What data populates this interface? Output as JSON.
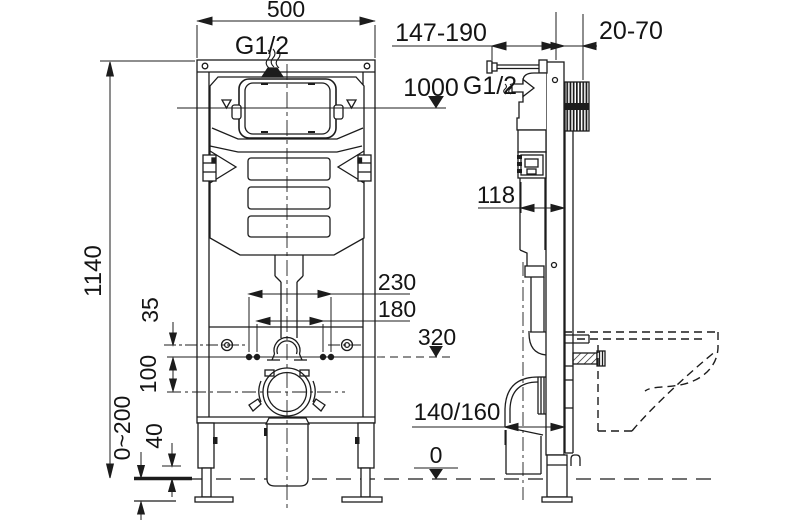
{
  "style": {
    "background": "#ffffff",
    "line_color": "#1c1c1c",
    "text_color": "#141414"
  },
  "front_view": {
    "width_label": "500",
    "inlet_label": "G1/2",
    "height_label": "1140",
    "bolt_spacing_outer": "230",
    "bolt_spacing_inner": "180",
    "hole_offset": "35",
    "hole_to_drain": "100",
    "leg_clearance": "40",
    "foot_adjust_range": "0~200"
  },
  "side_view": {
    "depth_range": "147-190",
    "wall_gap_range": "20-70",
    "supply_height": "1000",
    "inlet_label": "G1/2",
    "actuator_depth": "118",
    "outlet_height": "320",
    "drain_depth": "140/160",
    "floor_level": "0"
  }
}
